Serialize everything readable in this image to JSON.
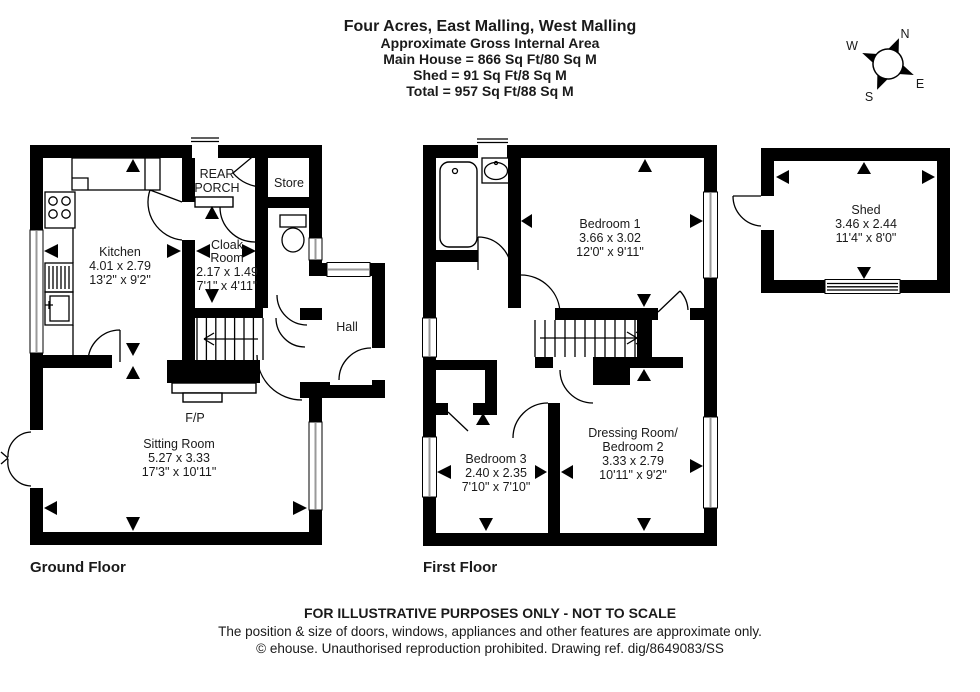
{
  "header": {
    "title": "Four Acres, East Malling, West Malling",
    "subtitle": "Approximate Gross Internal Area",
    "area_main": "Main House = 866 Sq Ft/80 Sq M",
    "area_shed": "Shed = 91 Sq Ft/8 Sq M",
    "area_total": "Total = 957 Sq Ft/88 Sq M"
  },
  "compass": {
    "north": "N",
    "east": "E",
    "south": "S",
    "west": "W"
  },
  "ground_floor": {
    "label": "Ground Floor",
    "kitchen": {
      "name": "Kitchen",
      "metric": "4.01 x 2.79",
      "imperial": "13'2\" x 9'2\""
    },
    "rear_porch": {
      "line1": "REAR",
      "line2": "PORCH"
    },
    "store": {
      "name": "Store"
    },
    "cloak_room": {
      "line1": "Cloak",
      "line2": "Room",
      "metric": "2.17 x 1.49",
      "imperial": "7'1\" x 4'11\""
    },
    "hall": {
      "name": "Hall"
    },
    "fireplace": {
      "name": "F/P"
    },
    "sitting_room": {
      "name": "Sitting Room",
      "metric": "5.27 x 3.33",
      "imperial": "17'3\" x 10'11\""
    }
  },
  "first_floor": {
    "label": "First Floor",
    "bedroom_1": {
      "name": "Bedroom 1",
      "metric": "3.66 x 3.02",
      "imperial": "12'0\" x 9'11\""
    },
    "bedroom_3": {
      "name": "Bedroom 3",
      "metric": "2.40 x 2.35",
      "imperial": "7'10\" x 7'10\""
    },
    "bedroom_2": {
      "line1": "Dressing Room/",
      "line2": "Bedroom 2",
      "metric": "3.33 x 2.79",
      "imperial": "10'11\" x 9'2\""
    }
  },
  "shed": {
    "name": "Shed",
    "metric": "3.46 x 2.44",
    "imperial": "11'4\" x 8'0\""
  },
  "footer": {
    "line1": "FOR ILLUSTRATIVE PURPOSES ONLY - NOT TO SCALE",
    "line2": "The position & size of doors, windows, appliances and other features are approximate only.",
    "line3": "© ehouse. Unauthorised reproduction prohibited. Drawing ref. dig/8649083/SS"
  },
  "colors": {
    "wall": "#000000",
    "ink": "#1a1a1a",
    "window_tint": "#9a9a9a",
    "background": "#ffffff"
  }
}
